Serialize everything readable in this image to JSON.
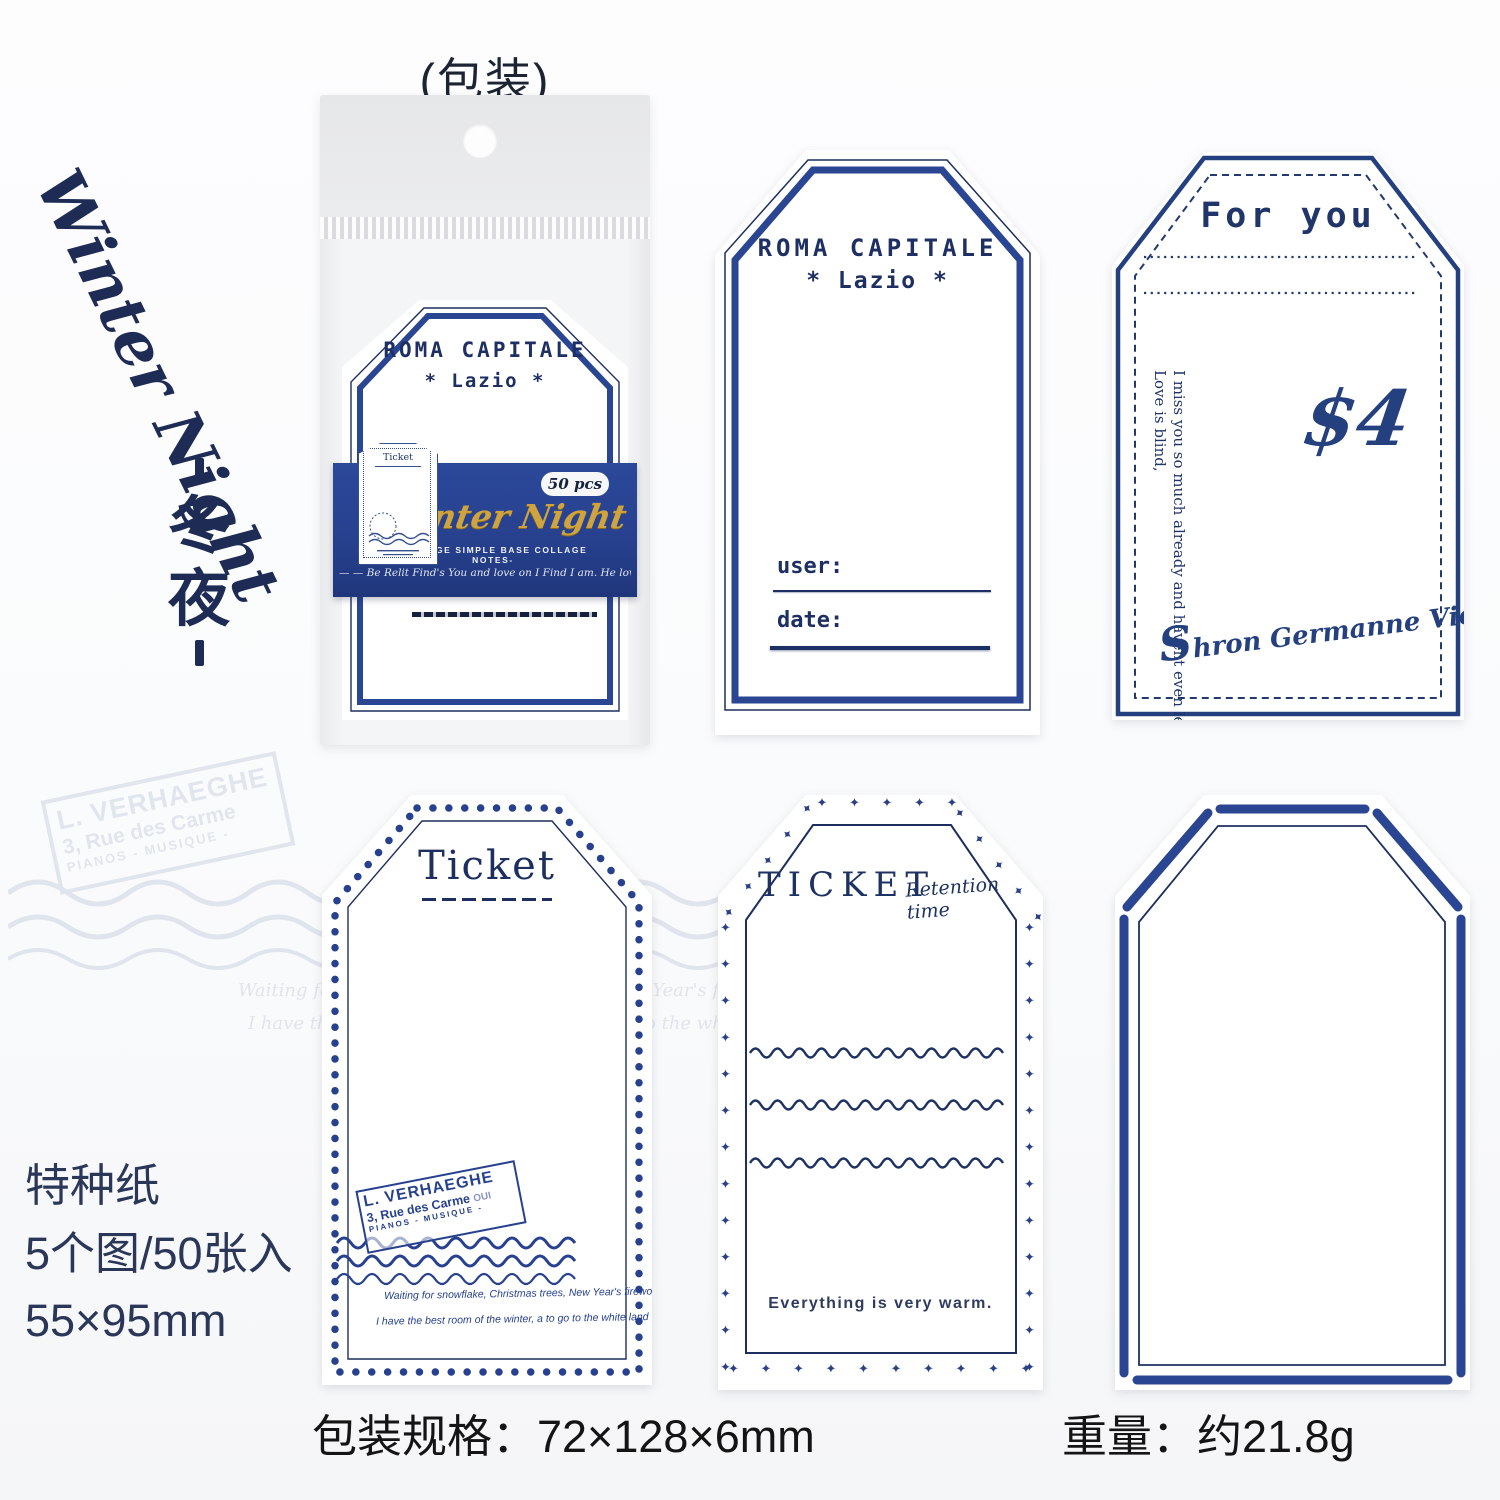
{
  "colors": {
    "navy": "#24386f",
    "band_blue": "#27418f",
    "gold": "#cfa43e",
    "ink_dark": "#1d2433",
    "spec_text": "#2a3758"
  },
  "header": {
    "package_label": "(包装)"
  },
  "side": {
    "title_en": "Winter Night",
    "title_zh_chars": [
      "冬",
      "夜"
    ]
  },
  "package": {
    "band": {
      "pcs": "50 pcs",
      "brand": "Winter Night",
      "subtitle": "-VINTAGE SIMPLE BASE COLLAGE NOTES-",
      "script_line": "— — Be Relit Find's You and love on I Find I am. He love a to the stay land — —"
    },
    "mini_ticket_title": "Ticket"
  },
  "tags": {
    "roma": {
      "title": "ROMA CAPITALE",
      "subtitle": "*  Lazio  *",
      "user_label": "user:",
      "date_label": "date:"
    },
    "for_you": {
      "title": "For you",
      "price": "$4",
      "vertical_line1": "Love is blind,",
      "vertical_line2": "I miss you so much already and havent even left yet!",
      "signature_initial": "S",
      "signature": "hron Germanne Vietze"
    },
    "ticket": {
      "title": "Ticket"
    },
    "ticket_retention": {
      "title": "TICKET",
      "script": "Retention time",
      "bottom_text": "Everything is very warm."
    }
  },
  "stamp": {
    "line1": "L. VERHAEGHE",
    "line2": "3, Rue des Carme",
    "line2_suffix": "OUI",
    "line3": "PIANOS - MUSIQUE -",
    "script1": "Waiting for snowflake, Christmas trees, New Year's fireworks, and better of us.",
    "script2": "I have the best room of the winter, a to go to the white land with you."
  },
  "footer": {
    "paper": "特种纸",
    "count": "5个图/50张入",
    "size": "55×95mm",
    "package_spec": "包装规格：72×128×6mm",
    "weight": "重量：约21.8g"
  },
  "decor": {
    "star": "✦ "
  }
}
